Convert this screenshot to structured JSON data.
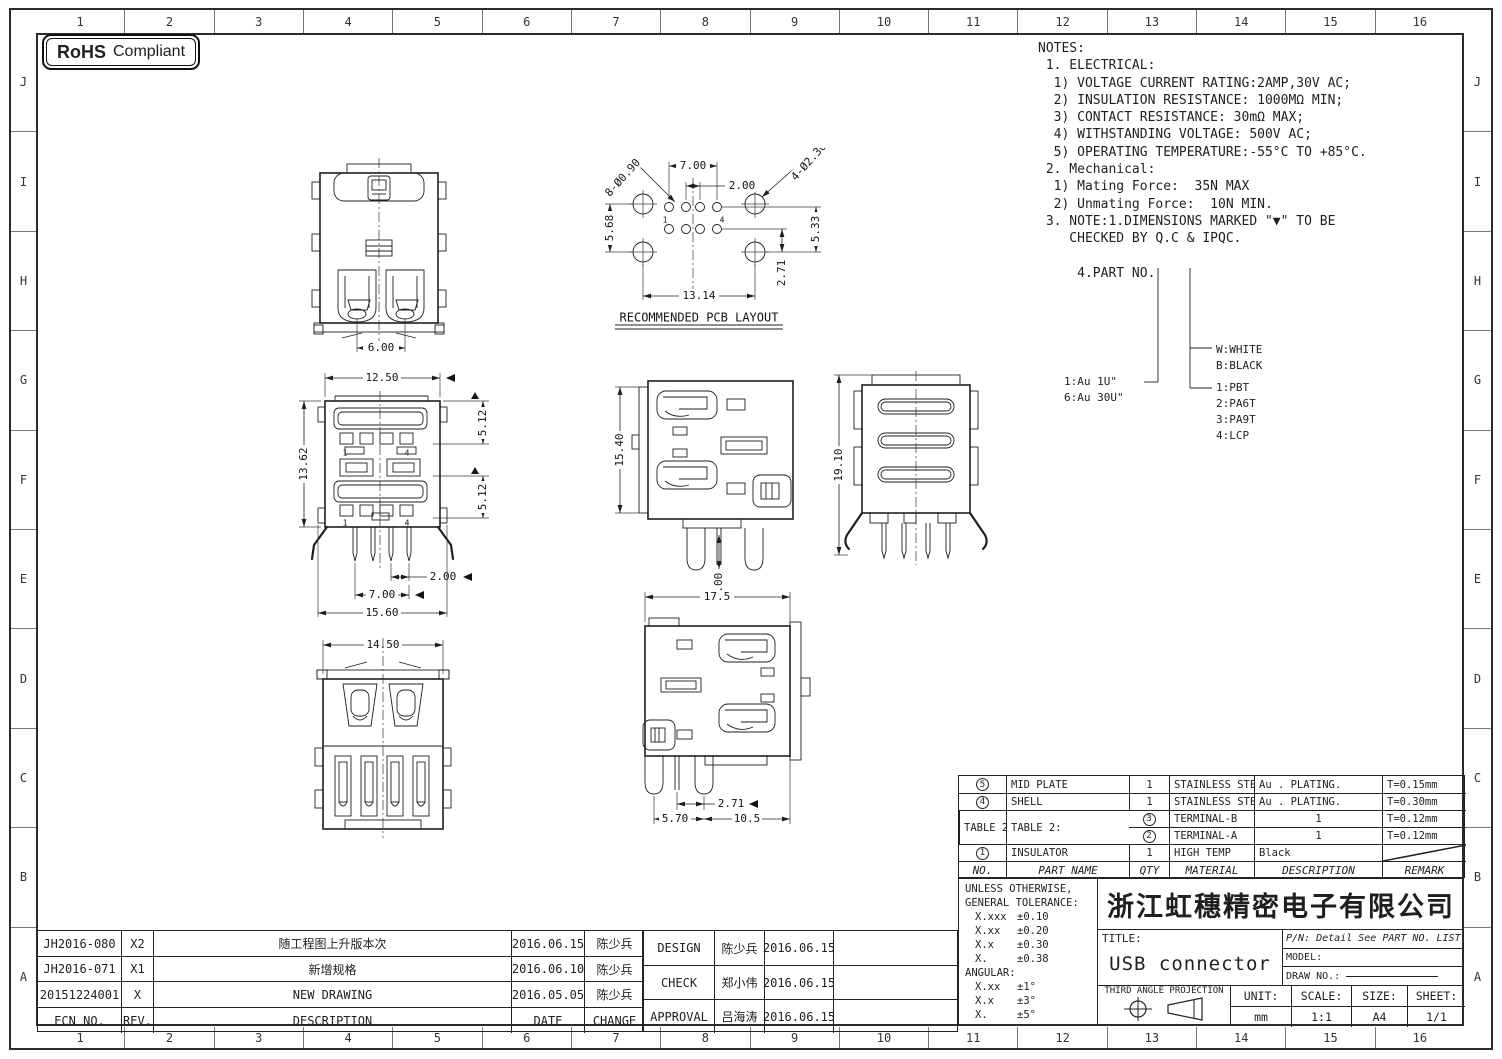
{
  "rohs": {
    "bold": "RoHS",
    "text": "Compliant"
  },
  "grid": {
    "cols": [
      "1",
      "2",
      "3",
      "4",
      "5",
      "6",
      "7",
      "8",
      "9",
      "10",
      "11",
      "12",
      "13",
      "14",
      "15",
      "16"
    ],
    "rows": [
      "J",
      "I",
      "H",
      "G",
      "F",
      "E",
      "D",
      "C",
      "B",
      "A"
    ]
  },
  "notes": {
    "lines": [
      "NOTES:",
      " 1. ELECTRICAL:",
      "  1) VOLTAGE CURRENT RATING:2AMP,30V AC;",
      "  2) INSULATION RESISTANCE: 1000MΩ MIN;",
      "  3) CONTACT RESISTANCE: 30mΩ MAX;",
      "  4) WITHSTANDING VOLTAGE: 500V AC;",
      "  5) OPERATING TEMPERATURE:-55°C TO +85°C.",
      " 2. Mechanical:",
      "  1) Mating Force:  35N MAX",
      "  2) Unmating Force:  10N MIN.",
      " 3. NOTE:1.DIMENSIONS MARKED \"▼\" TO BE",
      "    CHECKED BY Q.C & IPQC.",
      "",
      "     4.PART NO."
    ]
  },
  "part_no_legend": {
    "plating": [
      "1:Au 1U\"",
      "6:Au 30U\""
    ],
    "color": [
      "W:WHITE",
      "B:BLACK"
    ],
    "material": [
      "1:PBT",
      "2:PA6T",
      "3:PA9T",
      "4:LCP"
    ]
  },
  "views": {
    "top": {
      "dim_width": "6.00"
    },
    "pcb": {
      "label": "RECOMMENDED PCB LAYOUT",
      "dim_top": "7.00",
      "dim_pitch": "2.00",
      "leader_small": "8-Ø0.90",
      "leader_big": "4-Ø2.30",
      "dim_left": "5.68",
      "dim_right": "5.33",
      "dim_right2": "2.71",
      "dim_bottom": "13.14",
      "pin_labels": [
        "1",
        "4"
      ]
    },
    "front": {
      "dim_top": "12.50",
      "dim_height": "13.62",
      "dim_upper": "5.12",
      "dim_lower": "5.12",
      "dim_pitch": "2.00",
      "dim_span": "7.00",
      "dim_total": "15.60",
      "pin_labels": [
        "1",
        "4"
      ]
    },
    "side": {
      "dim_height": "15.40",
      "dim_pin": "3.00"
    },
    "rear": {
      "dim_height": "19.10"
    },
    "bottom": {
      "dim_width": "14.50"
    },
    "side2": {
      "dim_width": "17.5",
      "dim_pin_offset": "2.71",
      "dim_a": "5.70",
      "dim_b": "10.5"
    }
  },
  "parts_table": {
    "headers": {
      "no": "NO.",
      "part_name": "PART NAME",
      "qty": "QTY",
      "material": "MATERIAL",
      "description": "DESCRIPTION",
      "remark": "REMARK"
    },
    "rows": [
      {
        "no": "5",
        "part_name": "MID PLATE",
        "qty": "1",
        "material": "STAINLESS STEEL",
        "description": "Au . PLATING.",
        "remark": "T=0.15mm"
      },
      {
        "no": "4",
        "part_name": "SHELL",
        "qty": "1",
        "material": "STAINLESS STEEL",
        "description": "Au . PLATING.",
        "remark": "T=0.30mm"
      },
      {
        "no": "3",
        "part_name": "TERMINAL-B",
        "qty": "1",
        "material": "TABLE 2:",
        "description": "TABLE 2:",
        "remark": "T=0.12mm"
      },
      {
        "no": "2",
        "part_name": "TERMINAL-A",
        "qty": "1",
        "material": "",
        "description": "",
        "remark": "T=0.12mm"
      },
      {
        "no": "1",
        "part_name": "INSULATOR",
        "qty": "1",
        "material": "HIGH TEMP",
        "description": "Black",
        "remark": ""
      }
    ]
  },
  "tolerance": {
    "title1": "UNLESS OTHERWISE,",
    "title2": "GENERAL TOLERANCE:",
    "rows": [
      {
        "d": "X.xxx",
        "t": "±0.10"
      },
      {
        "d": "X.xx",
        "t": "±0.20"
      },
      {
        "d": "X.x",
        "t": "±0.30"
      },
      {
        "d": "X.",
        "t": "±0.38"
      }
    ],
    "angular": "ANGULAR:",
    "angular_rows": [
      {
        "d": "X.xx",
        "t": "±1°"
      },
      {
        "d": "X.x",
        "t": "±3°"
      },
      {
        "d": "X.",
        "t": "±5°"
      }
    ]
  },
  "title_block": {
    "company": "浙江虹穗精密电子有限公司",
    "title_label": "TITLE:",
    "title": "USB connector",
    "pn": "P/N: Detail See PART NO. LIST",
    "model_label": "MODEL:",
    "draw_no_label": "DRAW NO.:",
    "projection": "THIRD ANGLE PROJECTION",
    "unit_label": "UNIT:",
    "unit": "mm",
    "scale_label": "SCALE:",
    "scale": "1:1",
    "size_label": "SIZE:",
    "size": "A4",
    "sheet_label": "SHEET:",
    "sheet": "1/1"
  },
  "revision_table": {
    "headers": {
      "ecn": "ECN NO.",
      "rev": "REV.",
      "description": "DESCRIPTION",
      "date": "DATE",
      "change": "CHANGE"
    },
    "rows": [
      {
        "ecn": "JH2016-080",
        "rev": "X2",
        "description": "随工程图上升版本次",
        "date": "2016.06.15",
        "change": "陈少兵"
      },
      {
        "ecn": "JH2016-071",
        "rev": "X1",
        "description": "新增规格",
        "date": "2016.06.10",
        "change": "陈少兵"
      },
      {
        "ecn": "20151224001",
        "rev": "X",
        "description": "NEW DRAWING",
        "date": "2016.05.05",
        "change": "陈少兵"
      }
    ]
  },
  "approval_table": {
    "rows": [
      {
        "role": "DESIGN",
        "name": "陈少兵",
        "date": "2016.06.15"
      },
      {
        "role": "CHECK",
        "name": "郑小伟",
        "date": "2016.06.15"
      },
      {
        "role": "APPROVAL",
        "name": "吕海涛",
        "date": "2016.06.15"
      }
    ]
  }
}
